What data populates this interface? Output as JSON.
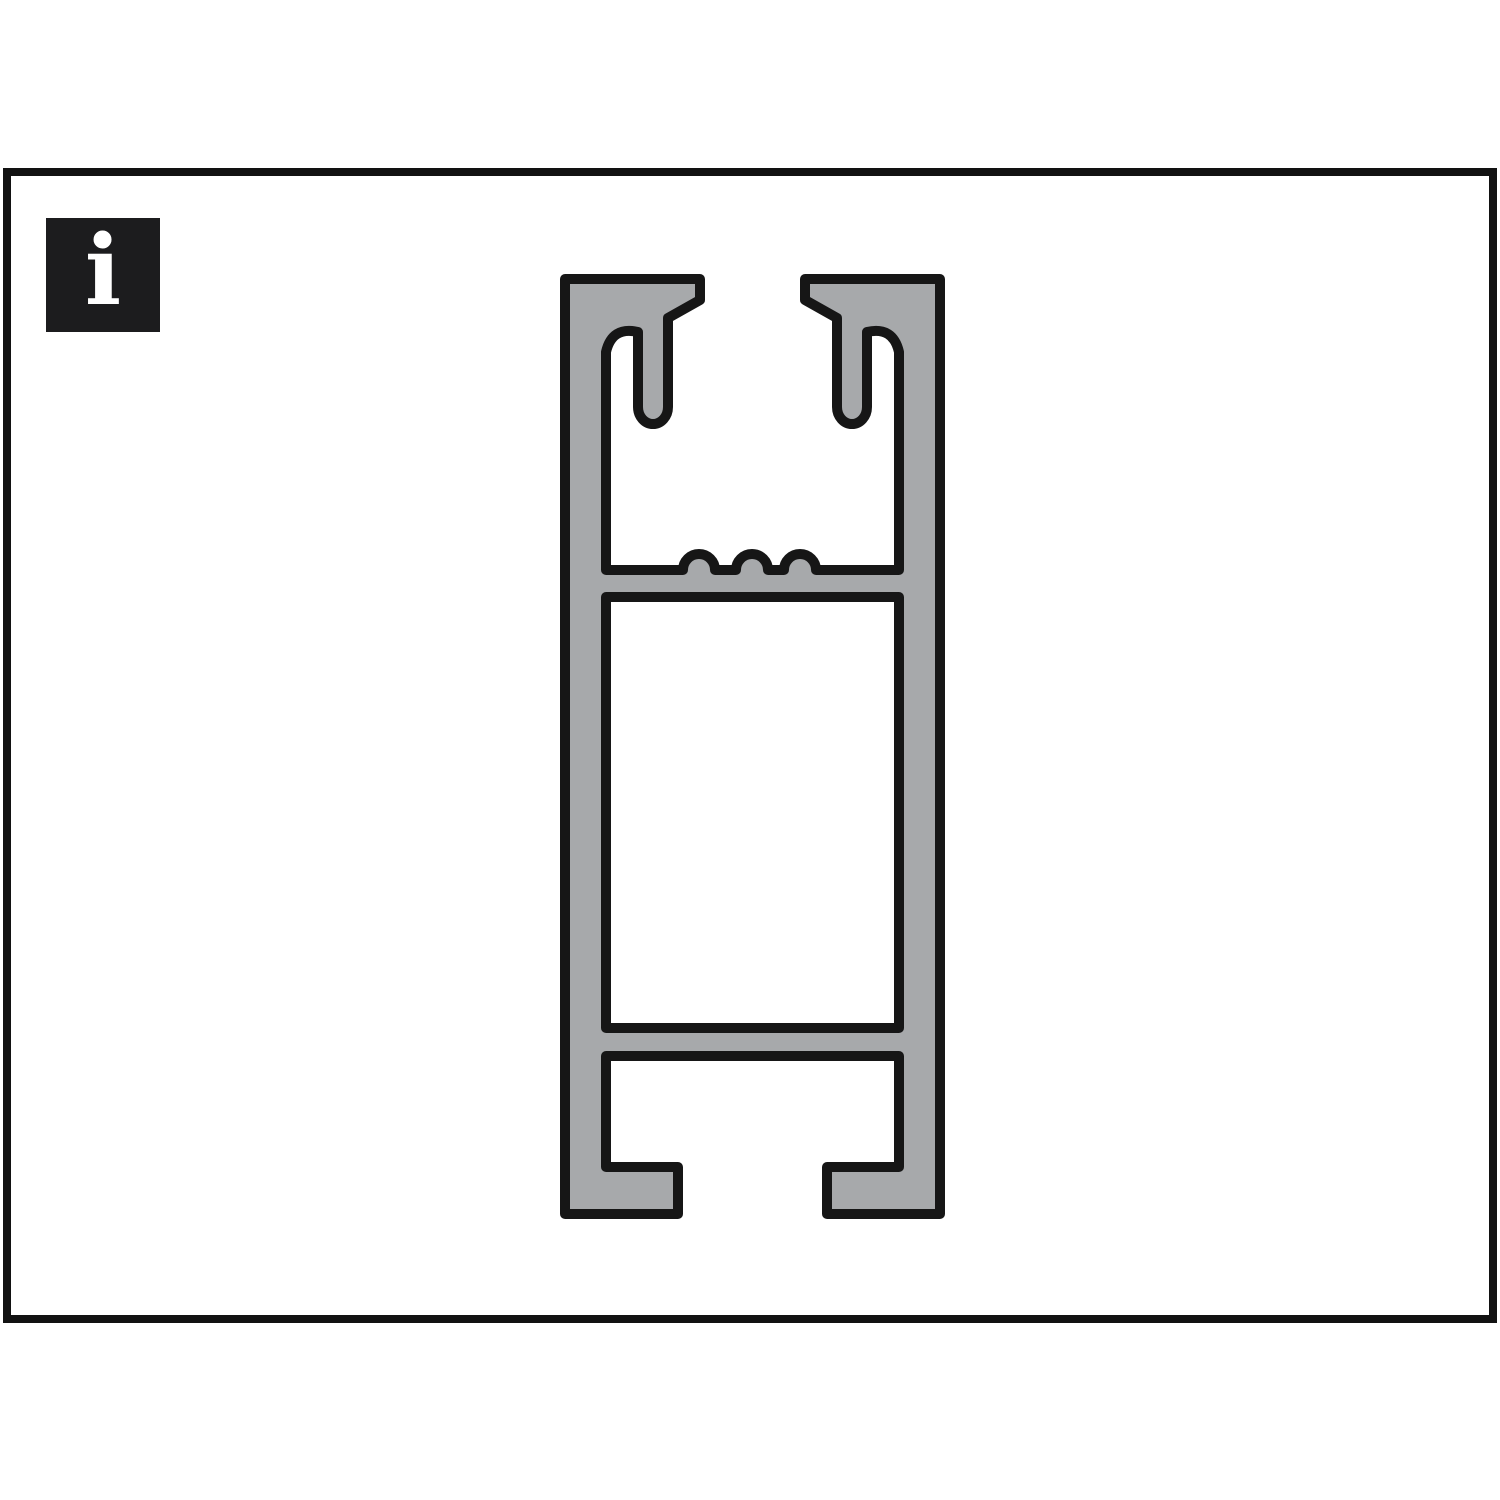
{
  "page": {
    "background": "#ffffff"
  },
  "frame": {
    "border_color": "#121212"
  },
  "info_badge": {
    "glyph": "i",
    "background": "#1c1c1e",
    "foreground": "#ffffff"
  },
  "profile": {
    "description": "Cross-section of an aluminium mounting rail profile: two top clip flanges with downward hook fingers, a serrated screw-retention shelf with three bumps, a hollow rectangular center chamber, and a bottom C-channel with inward-facing feet",
    "fill": "#a7a9ab",
    "outline": "#161616",
    "outline_width": "10",
    "path": "M 565 279 L 700 279 L 700 300 L 668 318 L 668 407 A 15 17 0 0 1 638 407 L 638 332 Q 612 326 606 352 L 606 570 L 683 570 A 16 16 0 0 1 715 570 L 736 570 A 16 16 0 0 1 768 570 L 784 570 A 16 16 0 0 1 816 570 L 899 570 L 899 352 Q 893 326 867 332 L 867 407 A 15 17 0 0 1 837 407 L 837 318 L 805 300 L 805 279 L 940 279 L 940 1214 L 827 1214 L 827 1167 L 899 1167 L 899 1056 L 606 1056 L 606 1167 L 678 1167 L 678 1214 L 565 1214 Z M 606 597 L 899 597 L 899 1028 L 606 1028 Z"
  }
}
